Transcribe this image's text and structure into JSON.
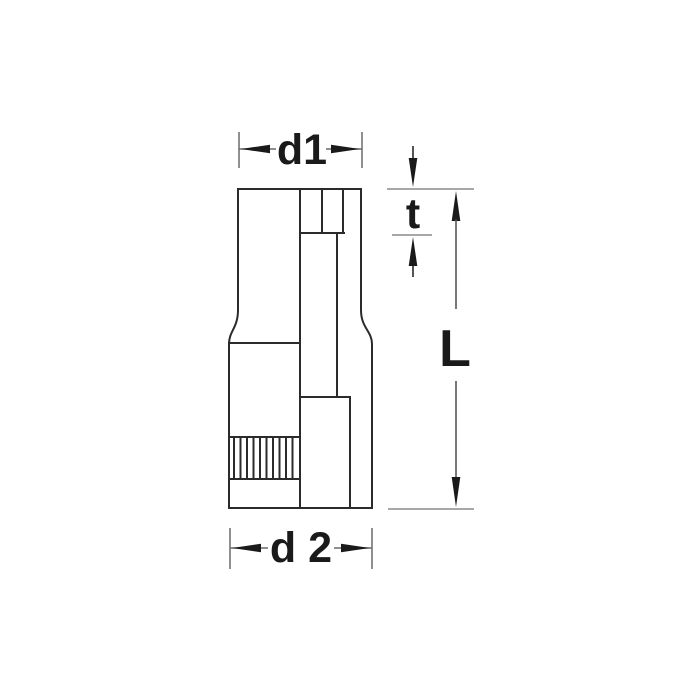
{
  "diagram": {
    "labels": {
      "d1": "d1",
      "t": "t",
      "length": "L",
      "d2": "d 2"
    },
    "colors": {
      "background": "#ffffff",
      "object_line": "#2b2b2b",
      "extension_line": "#6a6a6a",
      "reference_line": "#8a8a8a",
      "arrow_and_text": "#1a1a1a"
    }
  }
}
